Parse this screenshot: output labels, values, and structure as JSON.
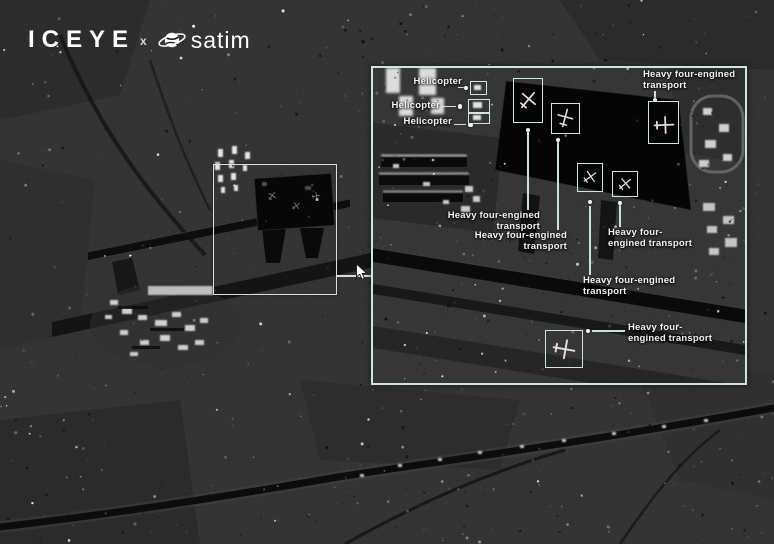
{
  "brand": {
    "iceye": "ICEYE",
    "separator": "x",
    "satim": "satim"
  },
  "colors": {
    "annotation_box": "#cde8e0",
    "leader_line": "#c7e4dc",
    "label_text": "#f3f3f3",
    "overview_rect": "#dfdfdf"
  },
  "inset": {
    "annotations": {
      "heli1": {
        "text": "Helicopter"
      },
      "heli2": {
        "text": "Helicopter"
      },
      "heli3": {
        "text": "Helicopter"
      },
      "t_topright": {
        "line1": "Heavy four-engined",
        "line2": "transport"
      },
      "t_a": {
        "line1": "Heavy four-engined",
        "line2": "transport"
      },
      "t_b": {
        "line1": "Heavy four-engined",
        "line2": "transport"
      },
      "t_c": {
        "line1": "Heavy four-",
        "line2": "engined transport"
      },
      "t_d": {
        "line1": "Heavy four-engined",
        "line2": "transport"
      },
      "t_e": {
        "line1": "Heavy four-",
        "line2": "engined transport"
      }
    }
  }
}
